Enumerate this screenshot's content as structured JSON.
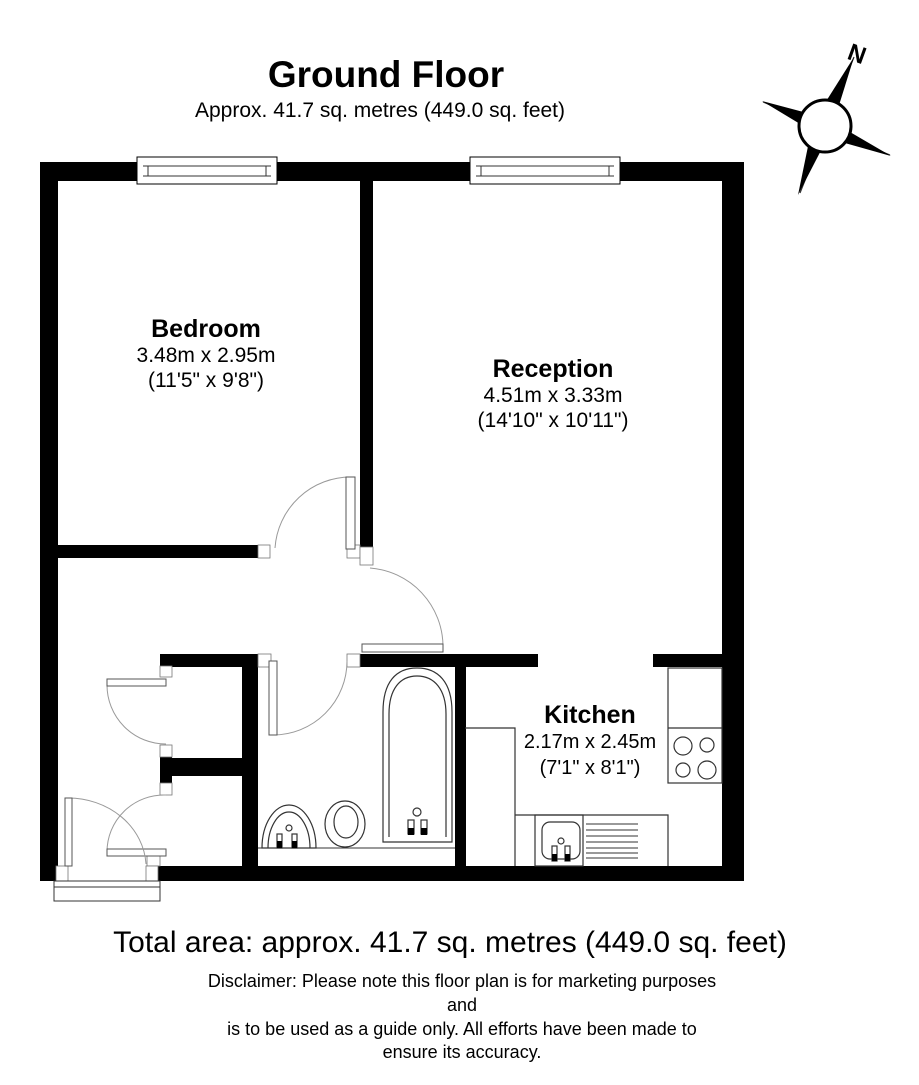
{
  "header": {
    "title": "Ground Floor",
    "subtitle": "Approx. 41.7 sq. metres (449.0 sq. feet)"
  },
  "compass": {
    "north_label": "N"
  },
  "rooms": [
    {
      "name": "Bedroom",
      "metric": "3.48m x 2.95m",
      "imperial": "(11'5\" x 9'8\")"
    },
    {
      "name": "Reception",
      "metric": "4.51m x 3.33m",
      "imperial": "(14'10\" x 10'11\")"
    },
    {
      "name": "Kitchen",
      "metric": "2.17m x 2.45m",
      "imperial": "(7'1\" x 8'1\")"
    }
  ],
  "footer": {
    "total_area": "Total area: approx. 41.7 sq. metres (449.0 sq. feet)",
    "disclaimer": [
      "Disclaimer: Please note this floor plan is for marketing purposes",
      "and",
      "is to be used as a guide only. All efforts have been made to",
      "ensure its accuracy."
    ]
  },
  "colors": {
    "wall": "#000000",
    "background": "#ffffff",
    "fixture_line": "#333333",
    "door_arc": "#999999"
  }
}
